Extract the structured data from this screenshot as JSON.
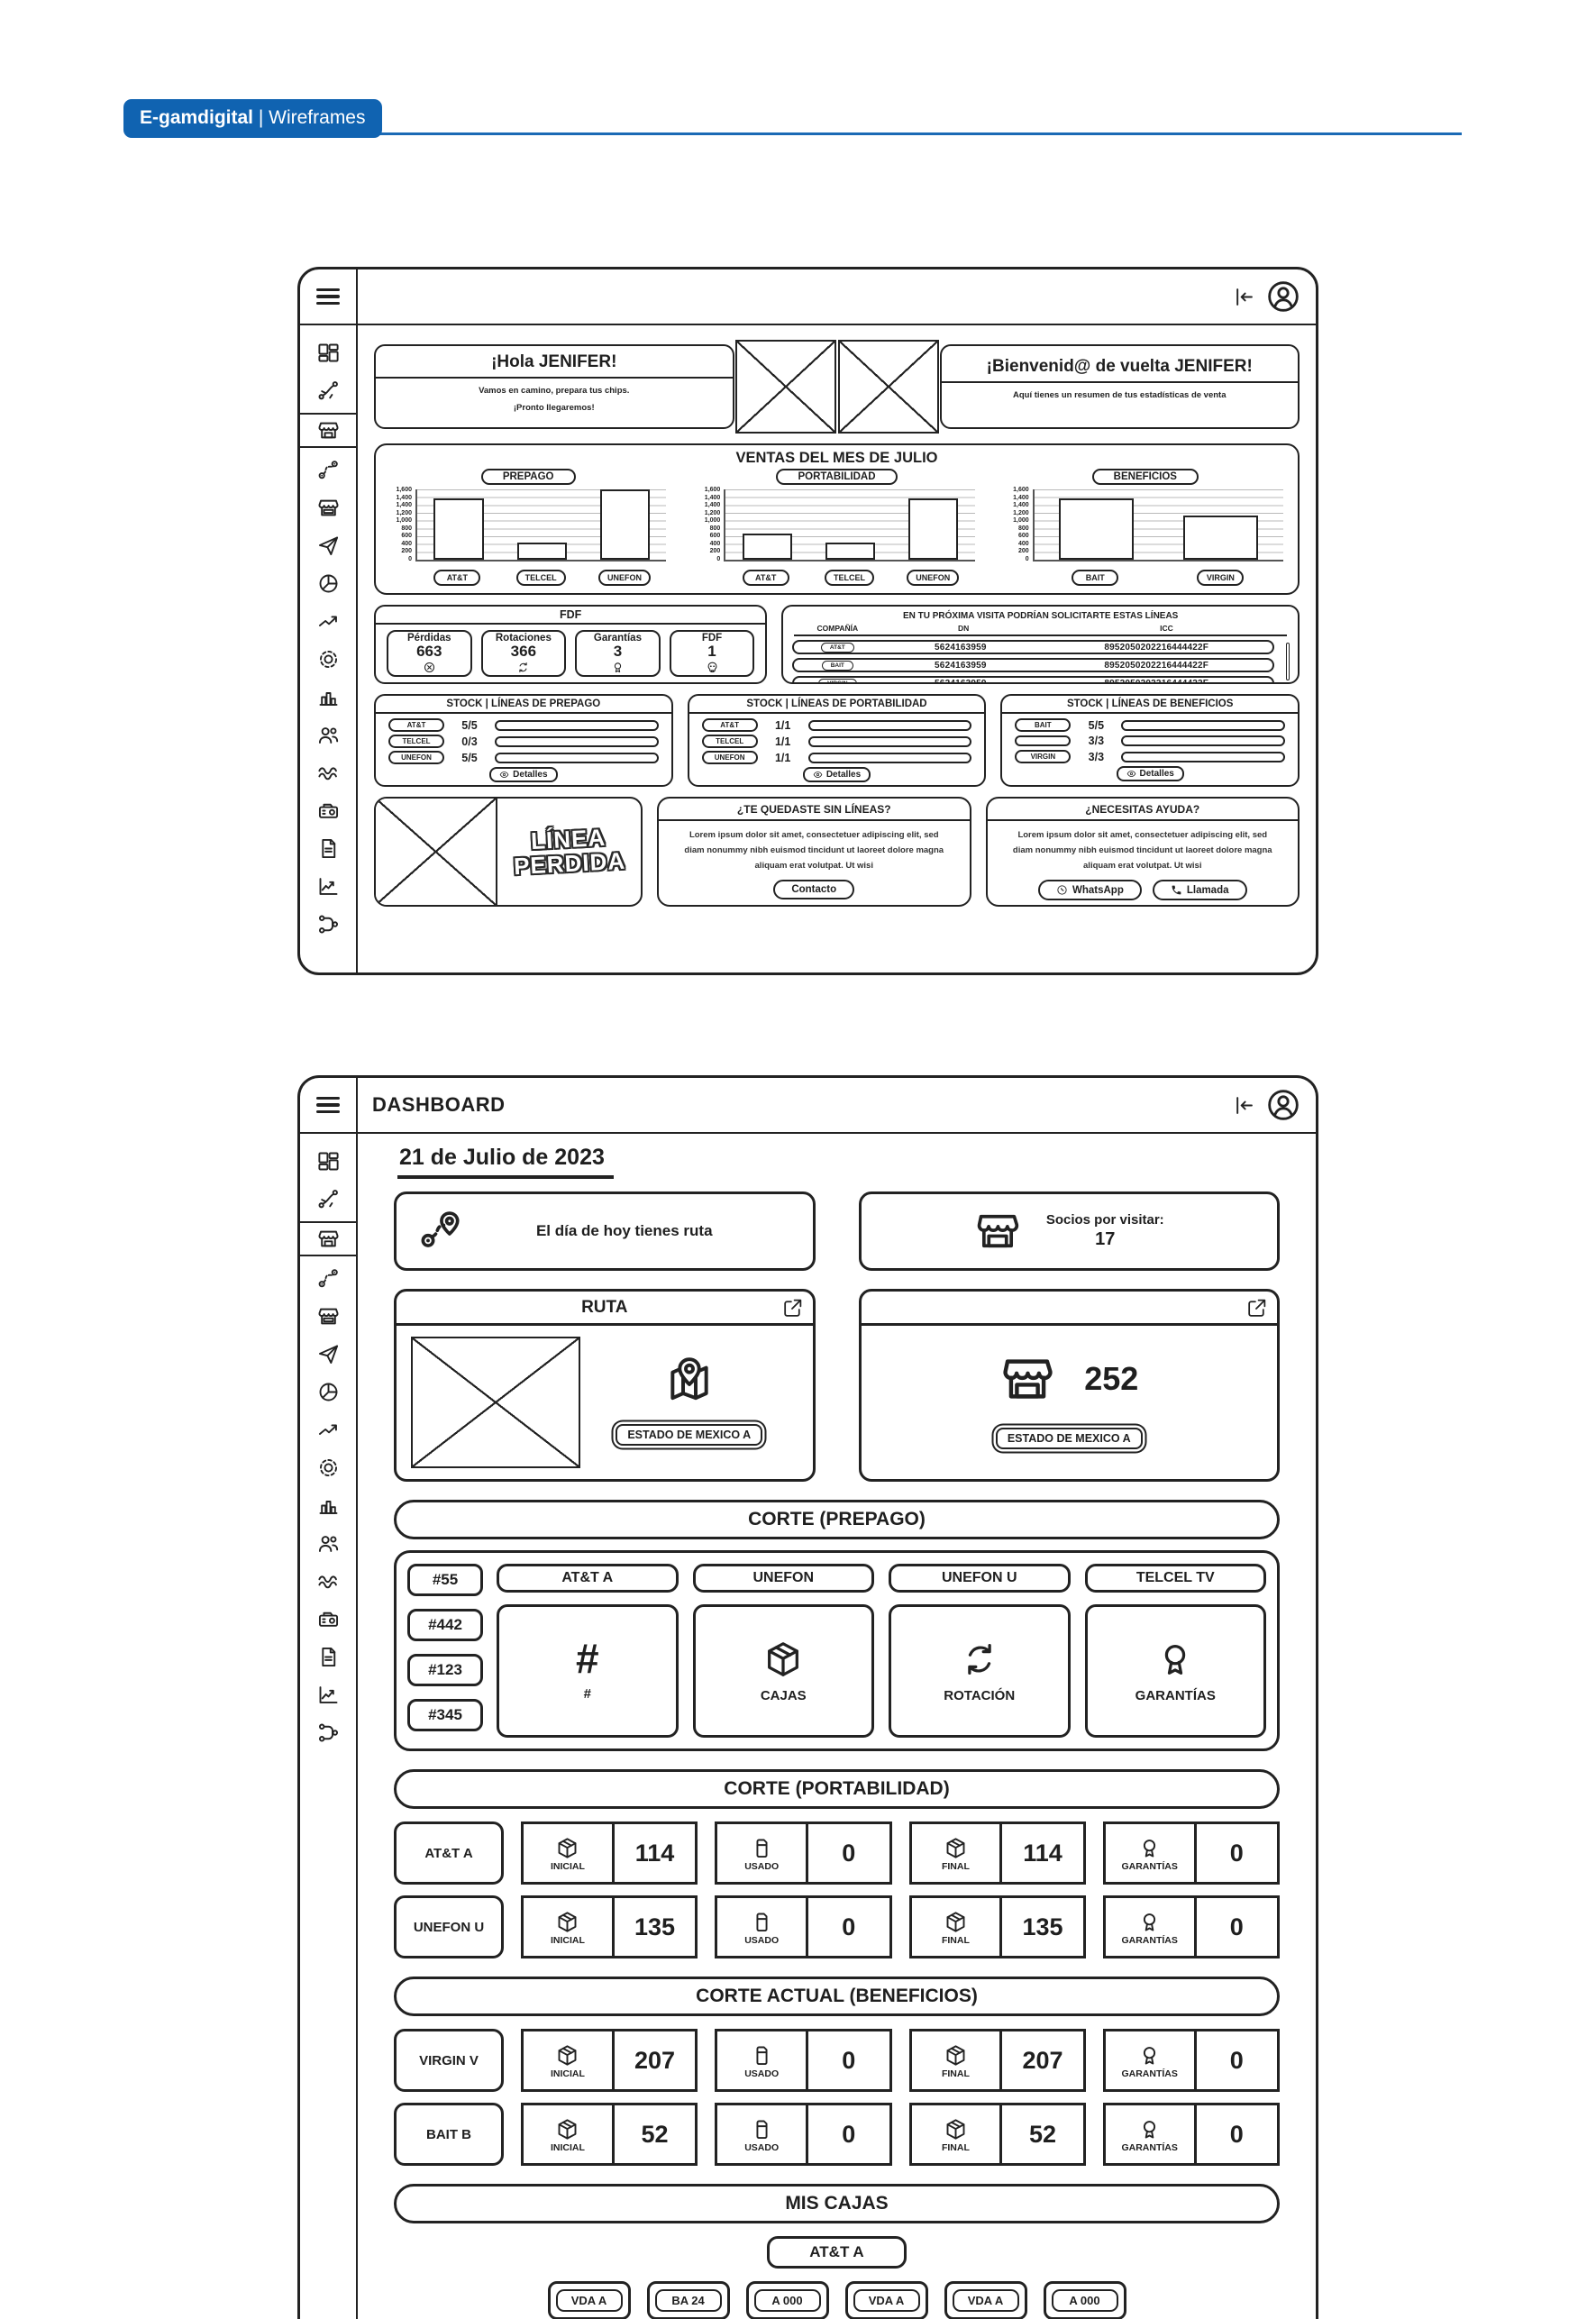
{
  "page": {
    "brand_bold": "E-gamdigital",
    "brand_light": "| Wireframes",
    "accent_blue": "#1063b1",
    "ink": "#222222"
  },
  "sidebar": {
    "items": [
      {
        "name": "dashboard",
        "icon": "dashboard",
        "selected": false
      },
      {
        "name": "routes",
        "icon": "split",
        "selected": false
      },
      {
        "name": "store",
        "icon": "store",
        "selected": true
      },
      {
        "name": "route-map",
        "icon": "route",
        "selected": false
      },
      {
        "name": "store-alt",
        "icon": "store2",
        "selected": false
      },
      {
        "name": "send",
        "icon": "send",
        "selected": false
      },
      {
        "name": "pie",
        "icon": "pie",
        "selected": false
      },
      {
        "name": "trend",
        "icon": "trend",
        "selected": false
      },
      {
        "name": "settings",
        "icon": "gear",
        "selected": false
      },
      {
        "name": "stats",
        "icon": "bars",
        "selected": false
      },
      {
        "name": "users",
        "icon": "users",
        "selected": false
      },
      {
        "name": "activity",
        "icon": "waves",
        "selected": false
      },
      {
        "name": "scanner",
        "icon": "scanner",
        "selected": false
      },
      {
        "name": "document",
        "icon": "doc",
        "selected": false
      },
      {
        "name": "reports",
        "icon": "linechart",
        "selected": false
      },
      {
        "name": "network",
        "icon": "network",
        "selected": false
      }
    ]
  },
  "screen1": {
    "greeting_left": {
      "title": "¡Hola JENIFER!",
      "line1": "Vamos en camino, prepara tus chips.",
      "line2": "¡Pronto llegaremos!"
    },
    "greeting_right": {
      "title": "¡Bienvenid@ de vuelta JENIFER!",
      "subtitle": "Aquí tienes un resumen de tus estadísticas de venta"
    },
    "charts_title": "VENTAS DEL MES DE JULIO",
    "fdf": {
      "title": "FDF",
      "stats": [
        {
          "label": "Pérdidas",
          "value": "663",
          "icon": "circlex"
        },
        {
          "label": "Rotaciones",
          "value": "366",
          "icon": "rotate"
        },
        {
          "label": "Garantías",
          "value": "3",
          "icon": "medal"
        },
        {
          "label": "FDF",
          "value": "1",
          "icon": "skull"
        }
      ]
    },
    "lines_table": {
      "title": "EN TU PRÓXIMA VISITA PODRÍAN SOLICITARTE ESTAS LÍNEAS",
      "columns": [
        "COMPAÑÍA",
        "DN",
        "ICC"
      ],
      "rows": [
        {
          "company": "AT&T",
          "dn": "5624163959",
          "icc": "8952050202216444422F"
        },
        {
          "company": "BAIT",
          "dn": "5624163959",
          "icc": "8952050202216444422F"
        },
        {
          "company": "VIRGIN",
          "dn": "5624163959",
          "icc": "8952050202216444422F"
        }
      ]
    },
    "stock_cards": [
      {
        "title": "STOCK | LÍNEAS DE PREPAGO",
        "rows": [
          {
            "chip": "AT&T",
            "value": "5/5"
          },
          {
            "chip": "TELCEL",
            "value": "0/3"
          },
          {
            "chip": "UNEFON",
            "value": "5/5"
          }
        ],
        "button": "Detalles"
      },
      {
        "title": "STOCK | LÍNEAS DE PORTABILIDAD",
        "rows": [
          {
            "chip": "AT&T",
            "value": "1/1"
          },
          {
            "chip": "TELCEL",
            "value": "1/1"
          },
          {
            "chip": "UNEFON",
            "value": "1/1"
          }
        ],
        "button": "Detalles"
      },
      {
        "title": "STOCK | LÍNEAS DE BENEFICIOS",
        "rows": [
          {
            "chip": "BAIT",
            "value": "5/5"
          },
          {
            "chip": "",
            "value": "3/3"
          },
          {
            "chip": "VIRGIN",
            "value": "3/3"
          }
        ],
        "button": "Detalles"
      }
    ],
    "linea_perdida": {
      "line1": "LÍNEA",
      "line2": "PERDIDA"
    },
    "help_cards": [
      {
        "title": "¿TE QUEDASTE SIN LÍNEAS?",
        "body": "Lorem ipsum dolor sit amet, consectetuer adipiscing elit, sed diam nonummy nibh euismod tincidunt ut laoreet dolore magna aliquam erat volutpat. Ut wisi",
        "buttons": [
          {
            "label": "Contacto",
            "icon": ""
          }
        ]
      },
      {
        "title": "¿NECESITAS AYUDA?",
        "body": "Lorem ipsum dolor sit amet, consectetuer adipiscing elit, sed diam nonummy nibh euismod tincidunt ut laoreet dolore magna aliquam erat volutpat. Ut wisi",
        "buttons": [
          {
            "label": "WhatsApp",
            "icon": "whatsapp"
          },
          {
            "label": "Llamada",
            "icon": "phone"
          }
        ]
      }
    ]
  },
  "chart_data": [
    {
      "type": "bar",
      "title": "PREPAGO",
      "categories": [
        "AT&T",
        "TELCEL",
        "UNEFON"
      ],
      "values": [
        1400,
        400,
        1600
      ],
      "ylim": [
        0,
        1600
      ],
      "yticks": [
        "1,600",
        "1,400",
        "1,400",
        "1,200",
        "1,000",
        "800",
        "600",
        "400",
        "200",
        "0"
      ],
      "xlabel": "",
      "ylabel": "",
      "grid": true,
      "legend": "none"
    },
    {
      "type": "bar",
      "title": "PORTABILIDAD",
      "categories": [
        "AT&T",
        "TELCEL",
        "UNEFON"
      ],
      "values": [
        600,
        400,
        1400
      ],
      "ylim": [
        0,
        1600
      ],
      "yticks": [
        "1,600",
        "1,400",
        "1,400",
        "1,200",
        "1,000",
        "800",
        "600",
        "400",
        "200",
        "0"
      ],
      "xlabel": "",
      "ylabel": "",
      "grid": true,
      "legend": "none"
    },
    {
      "type": "bar",
      "title": "BENEFICIOS",
      "categories": [
        "BAIT",
        "VIRGIN"
      ],
      "values": [
        1400,
        1000
      ],
      "ylim": [
        0,
        1600
      ],
      "yticks": [
        "1,600",
        "1,400",
        "1,400",
        "1,200",
        "1,000",
        "800",
        "600",
        "400",
        "200",
        "0"
      ],
      "xlabel": "",
      "ylabel": "",
      "grid": true,
      "legend": "none"
    }
  ],
  "screen2": {
    "title": "DASHBOARD",
    "date": "21 de Julio de 2023",
    "route_banner": "El día de hoy tienes ruta",
    "socios_banner": {
      "label": "Socios por visitar:",
      "value": "17"
    },
    "ruta_card": {
      "title": "RUTA",
      "button": "ESTADO DE MEXICO A"
    },
    "socios_card": {
      "value": "252",
      "button": "ESTADO DE MEXICO A"
    },
    "corte_prepago": {
      "header": "CORTE (PREPAGO)",
      "chips": [
        "#55",
        "#442",
        "#123",
        "#345"
      ],
      "tabs": [
        "AT&T A",
        "UNEFON",
        "UNEFON U",
        "TELCEL TV"
      ],
      "cards": [
        {
          "big": "#",
          "label": "#",
          "icon": ""
        },
        {
          "big": "",
          "label": "CAJAS",
          "icon": "box"
        },
        {
          "big": "",
          "label": "ROTACIÓN",
          "icon": "rotate"
        },
        {
          "big": "",
          "label": "GARANTÍAS",
          "icon": "medal"
        }
      ]
    },
    "stat_labels": [
      "INICIAL",
      "USADO",
      "FINAL",
      "GARANTÍAS"
    ],
    "stat_icons": [
      "box",
      "sim",
      "box",
      "medal"
    ],
    "corte_portabilidad": {
      "header": "CORTE (PORTABILIDAD)",
      "rows": [
        {
          "label": "AT&T A",
          "values": [
            "114",
            "0",
            "114",
            "0"
          ]
        },
        {
          "label": "UNEFON U",
          "values": [
            "135",
            "0",
            "135",
            "0"
          ]
        }
      ]
    },
    "corte_beneficios": {
      "header": "CORTE ACTUAL (BENEFICIOS)",
      "rows": [
        {
          "label": "VIRGIN V",
          "values": [
            "207",
            "0",
            "207",
            "0"
          ]
        },
        {
          "label": "BAIT B",
          "values": [
            "52",
            "0",
            "52",
            "0"
          ]
        }
      ]
    },
    "mis_cajas": {
      "header": "MIS CAJAS",
      "tab": "AT&T A",
      "bottom_chips": [
        "VDA A",
        "BA 24",
        "A 000",
        "VDA A",
        "VDA A",
        "A 000"
      ]
    }
  }
}
